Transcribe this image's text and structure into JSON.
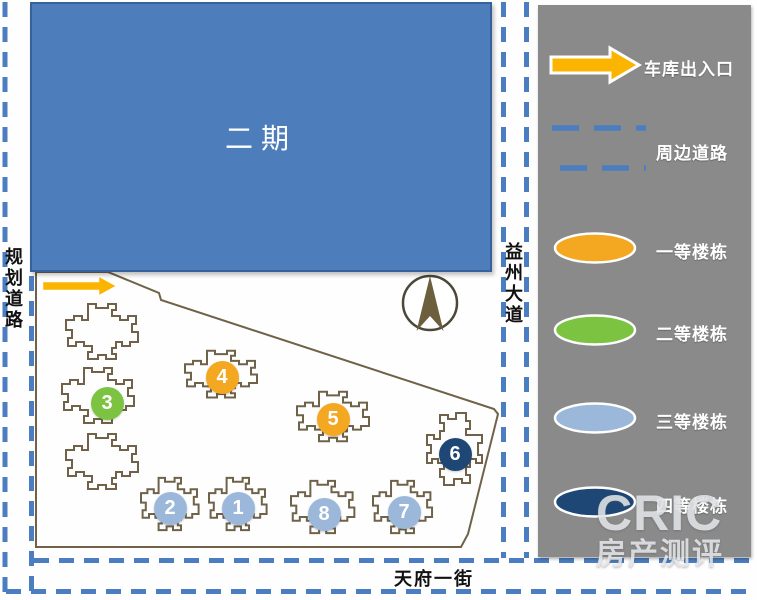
{
  "colors": {
    "road_blue": "#4B7EC0",
    "phase2_fill": "#4D7EBB",
    "phase2_border": "#36619B",
    "panel_gray": "#8A8A8A",
    "building_outline": "#6F6249",
    "arrow_yellow": "#FBB400",
    "compass_arrow": "#6B5F3E",
    "tier1": "#F4A720",
    "tier2": "#7CC342",
    "tier3": "#9BB8DB",
    "tier4": "#1E4775"
  },
  "map": {
    "phase2_label": "二期",
    "road_left": "规划道路",
    "road_right": "益州大道",
    "road_bottom": "天府一街",
    "buildings": [
      {
        "num": "1",
        "tier": "tier3",
        "x": 238,
        "y": 508
      },
      {
        "num": "2",
        "tier": "tier3",
        "x": 170,
        "y": 508
      },
      {
        "num": "3",
        "tier": "tier2",
        "x": 107,
        "y": 403
      },
      {
        "num": "4",
        "tier": "tier1",
        "x": 222,
        "y": 377
      },
      {
        "num": "5",
        "tier": "tier1",
        "x": 333,
        "y": 419
      },
      {
        "num": "6",
        "tier": "tier4",
        "x": 455,
        "y": 454
      },
      {
        "num": "7",
        "tier": "tier3",
        "x": 404,
        "y": 512
      },
      {
        "num": "8",
        "tier": "tier3",
        "x": 324,
        "y": 514
      }
    ]
  },
  "legend": {
    "items": [
      {
        "label": "车库出入口",
        "swatch": "arrow"
      },
      {
        "label": "周边道路",
        "swatch": "dashes"
      },
      {
        "label": "一等楼栋",
        "swatch": "ellipse",
        "tier": "tier1"
      },
      {
        "label": "二等楼栋",
        "swatch": "ellipse",
        "tier": "tier2"
      },
      {
        "label": "三等楼栋",
        "swatch": "ellipse",
        "tier": "tier3"
      },
      {
        "label": "四等楼栋",
        "swatch": "ellipse",
        "tier": "tier4"
      }
    ]
  },
  "watermark": {
    "line1": "CRIC",
    "line2": "房产测评"
  }
}
